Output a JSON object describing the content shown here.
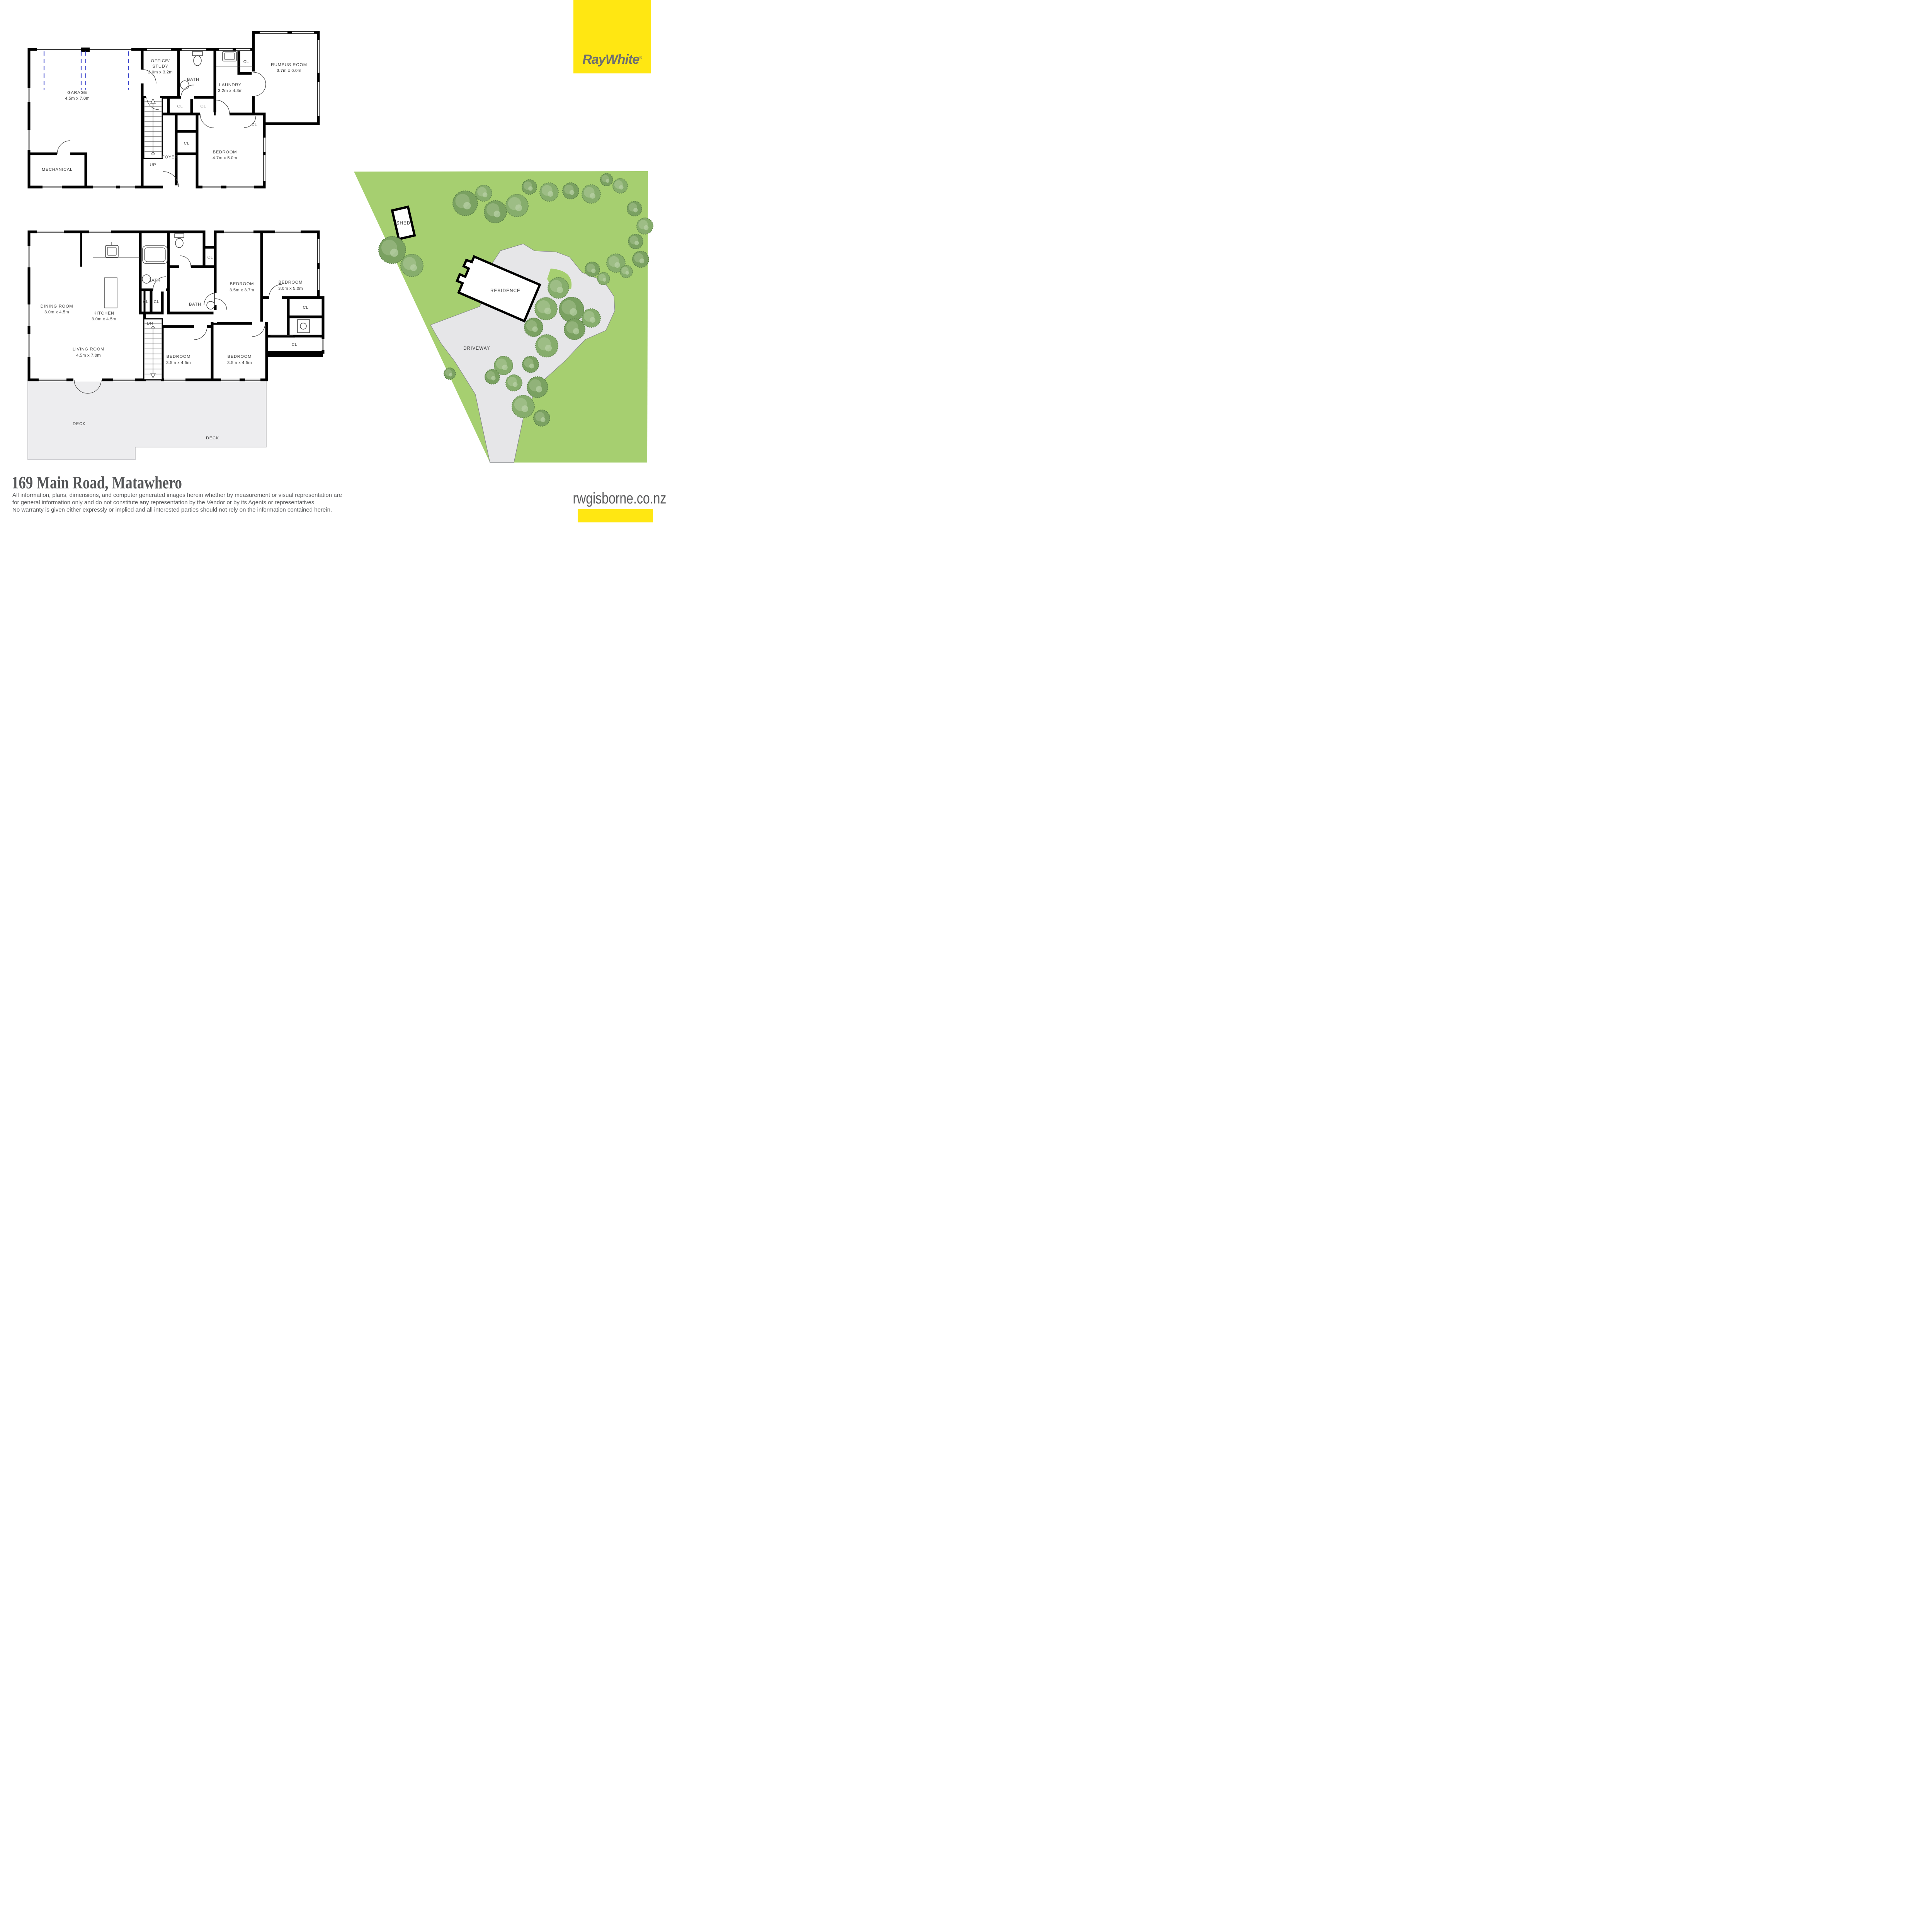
{
  "brand": {
    "name": "RayWhite",
    "registered": "®"
  },
  "plan1": {
    "garage": {
      "label": "GARAGE",
      "dims": "4.5m x 7.0m"
    },
    "mechanical": {
      "label": "MECHANICAL"
    },
    "office": {
      "line1": "OFFICE/",
      "line2": "STUDY",
      "dims": "2.0m x 3.2m"
    },
    "bath": {
      "label": "BATH"
    },
    "laundry": {
      "label": "LAUNDRY",
      "dims": "3.2m x 4.3m"
    },
    "rumpus": {
      "label": "RUMPUS ROOM",
      "dims": "3.7m x 6.0m"
    },
    "bedroom": {
      "label": "BEDROOM",
      "dims": "4.7m x 5.0m"
    },
    "foyer": {
      "label": "FOYER"
    },
    "stairs": {
      "label": "UP"
    },
    "closet": "CL"
  },
  "plan2": {
    "dining": {
      "label": "DINING ROOM",
      "dims": "3.0m x 4.5m"
    },
    "kitchen": {
      "label": "KITCHEN",
      "dims": "3.0m x 4.5m"
    },
    "bath1": {
      "label": "BATH"
    },
    "bath2": {
      "label": "BATH"
    },
    "bedroom1": {
      "label": "BEDROOM",
      "dims": "3.5m x 3.7m"
    },
    "bedroom2": {
      "label": "BEDROOM",
      "dims": "3.0m x 5.0m"
    },
    "bedroom3": {
      "label": "BEDROOM",
      "dims": "3.5m x 4.5m"
    },
    "bedroom4": {
      "label": "BEDROOM",
      "dims": "3.5m x 4.5m"
    },
    "living": {
      "label": "LIVING ROOM",
      "dims": "4.5m x 7.0m"
    },
    "deck": "DECK",
    "stairs": {
      "label": "DN"
    },
    "closet": "CL"
  },
  "site": {
    "shed": "SHED",
    "residence": "RESIDENCE",
    "driveway": "DRIVEWAY"
  },
  "footer": {
    "address": "169 Main Road, Matawhero",
    "disclaimer": [
      "All information, plans, dimensions, and computer generated images herein whether by measurement or visual representation are",
      "for general information only and do not constitute any representation by the Vendor or by its Agents or representatives.",
      "No warranty is given either expressly or implied and all interested parties should not rely on the information contained herein."
    ],
    "website": "rwgisborne.co.nz"
  },
  "colors": {
    "brand_yellow": "#ffe712",
    "logo_gray": "#6d6e71",
    "site_green": "#a6cf70",
    "tree_green": "#7fa968",
    "driveway_gray": "#e6e6e8",
    "deck_gray": "#ededef",
    "text_gray": "#58595b",
    "garage_door_blue": "#2a35c8"
  }
}
